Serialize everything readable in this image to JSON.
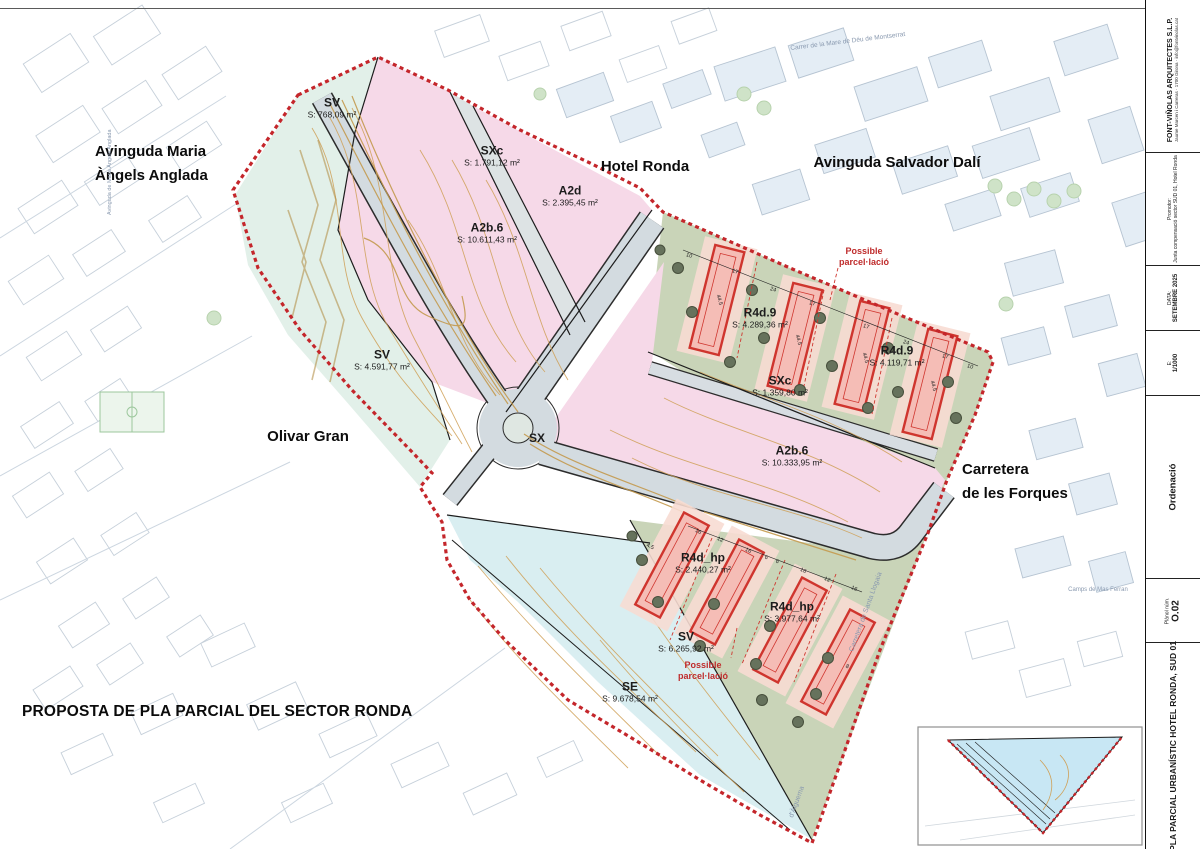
{
  "palette": {
    "boundary_red": "#c4262b",
    "zone_pink": "#f6d9e8",
    "zone_green": "#c9d4b8",
    "zone_teal": "#dff0ec",
    "road_grey": "#d3dbe0",
    "building_red": "#cf352e",
    "contour_orange": "#cfa057",
    "inset_blue": "#c8e7f4"
  },
  "sheet": {
    "proposal_title": "PROPOSTA DE PLA PARCIAL DEL SECTOR RONDA"
  },
  "title_block": {
    "architect": "FONT-VIÑOLAS ARQUITECTES S.L.P.",
    "architect_info": "Jaume Marcen i Carreras · 1700 Girona · info@fontvinolas.cat",
    "promotor_label": "Promotor:",
    "promotor": "Junta compensació sector SUD 01, Hotel Ronda",
    "date_label": "DATA:",
    "date": "SETEMBRE 2025",
    "scale_label": "E:",
    "scale": "1/1000",
    "section": "Ordenació",
    "plan_label": "Plànol núm.",
    "plan_number": "O.02",
    "project": "PLA PARCIAL URBANÍSTIC HOTEL RONDA, SUD 01"
  },
  "streets": {
    "anglada_1": "Avinguda Maria",
    "anglada_2": "Àngels Anglada",
    "hotel_ronda": "Hotel Ronda",
    "salvador_dali": "Avinguda Salvador Dalí",
    "olivar_gran": "Olivar Gran",
    "forques_1": "Carretera",
    "forques_2": "de les Forques",
    "montserrat": "Carrer de la Mare de Déu de Montserrat",
    "anglada_small": "Avinguda de Maria Àngels Anglada",
    "santa_llogaia": "Carretera de Santa Llogaia",
    "alguema": "d'Àlguema",
    "mas_ferran": "Camps de Mas Ferran"
  },
  "zones": [
    {
      "code": "SV",
      "area": "S: 768,09 m²"
    },
    {
      "code": "SXc",
      "area": "S: 1.791,12 m²"
    },
    {
      "code": "A2d",
      "area": "S: 2.395,45 m²"
    },
    {
      "code": "A2b.6",
      "area": "S: 10.611,43 m²"
    },
    {
      "code": "R4d.9",
      "area": "S: 4.289,36 m²"
    },
    {
      "code": "R4d.9",
      "area": "S: 4.119,71 m²"
    },
    {
      "code": "SXc",
      "area": "S: 1.359,80 m²"
    },
    {
      "code": "A2b.6",
      "area": "S: 10.333,95 m²"
    },
    {
      "code": "SV",
      "area": "S: 4.591,77 m²"
    },
    {
      "code": "SX",
      "area": ""
    },
    {
      "code": "R4d_hp",
      "area": "S: 2.440,27 m²"
    },
    {
      "code": "R4d_hp",
      "area": "S: 3.977,64 m²"
    },
    {
      "code": "SV",
      "area": "S: 6.265,92 m²"
    },
    {
      "code": "SE",
      "area": "S: 9.678,54 m²"
    }
  ],
  "notes": {
    "possible_1": "Possible",
    "possible_2": "parcel·lació"
  },
  "dims": [
    "10",
    "17",
    "24",
    "17",
    "17",
    "24",
    "17",
    "10",
    "44.5",
    "44.5",
    "44.5",
    "44.5",
    "16",
    "12",
    "16",
    "6",
    "6",
    "16",
    "12",
    "16",
    "4.5",
    "8"
  ]
}
